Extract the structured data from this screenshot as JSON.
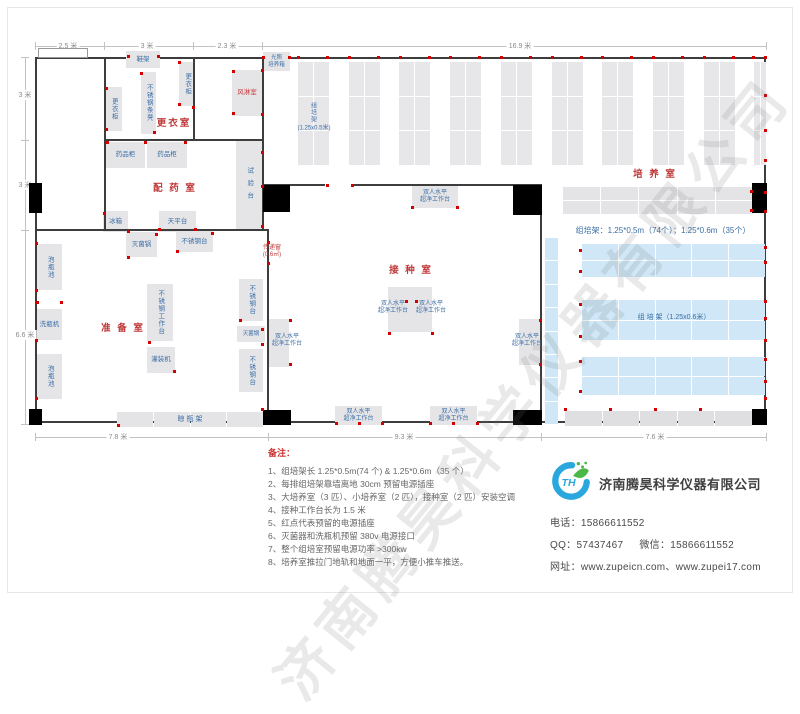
{
  "watermark": "济南腾昊科学仪器有限公司",
  "plan": {
    "rooms": [
      {
        "n": "changing-room",
        "l": "更衣室",
        "x": 174,
        "y": 122
      },
      {
        "n": "medicine-prep-room",
        "l": "配 药 室",
        "x": 175,
        "y": 187
      },
      {
        "n": "prep-room",
        "l": "准 备 室",
        "x": 123,
        "y": 327
      },
      {
        "n": "inoculation-room",
        "l": "接 种 室",
        "x": 411,
        "y": 269
      },
      {
        "n": "culture-room",
        "l": "培 养 室",
        "x": 655,
        "y": 173
      }
    ],
    "dim_top": [
      {
        "label": "2.5 米",
        "cx": 68
      },
      {
        "label": "3 米",
        "cx": 147
      },
      {
        "label": "2.3 米",
        "cx": 227
      },
      {
        "label": "16.9 米",
        "cx": 520
      }
    ],
    "dim_left": [
      {
        "label": "3 米",
        "cy": 95
      },
      {
        "label": "3 米",
        "cy": 185
      },
      {
        "label": "6.6 米",
        "cy": 335
      }
    ],
    "dim_bottom": [
      {
        "label": "7.8 米",
        "cx": 118
      },
      {
        "label": "9.3 米",
        "cx": 404
      },
      {
        "label": "7.6 米",
        "cx": 655
      }
    ],
    "dim_top_ticks": [
      35,
      104,
      193,
      262,
      766
    ],
    "dim_left_ticks": [
      57,
      140,
      230,
      424
    ],
    "dim_bottom_ticks": [
      35,
      268,
      541,
      766
    ],
    "walls": [
      [
        104,
        57,
        2,
        173
      ],
      [
        193,
        57,
        2,
        83
      ],
      [
        262,
        57,
        2,
        173
      ],
      [
        104,
        139,
        160,
        2
      ],
      [
        35,
        229,
        233,
        2
      ],
      [
        267,
        229,
        2,
        196
      ],
      [
        262,
        184,
        280,
        2
      ],
      [
        540,
        184,
        2,
        241
      ]
    ],
    "openings": [
      [
        325,
        181,
        28,
        7
      ]
    ],
    "doors": [
      [
        29,
        183,
        13,
        30
      ],
      [
        29,
        409,
        13,
        16
      ],
      [
        263,
        185,
        27,
        27
      ],
      [
        513,
        185,
        29,
        30
      ],
      [
        263,
        410,
        28,
        15
      ],
      [
        513,
        410,
        29,
        15
      ],
      [
        752,
        183,
        15,
        30
      ],
      [
        752,
        409,
        15,
        16
      ]
    ],
    "window": [
      38,
      48,
      48,
      8
    ],
    "rack_columns": {
      "x0": 298,
      "step": 50.7,
      "count": 10,
      "w": 31,
      "y": 62,
      "h": 103,
      "r": 3,
      "c": 2,
      "clip": 766
    },
    "rack_grids": [
      {
        "x": 563,
        "y": 187,
        "w": 190,
        "h": 27,
        "r": 2,
        "c": 5,
        "col": "#e4e4e7"
      },
      {
        "x": 117,
        "y": 412,
        "w": 146,
        "h": 15,
        "r": 1,
        "c": 4,
        "col": "#e4e4e7"
      },
      {
        "x": 565,
        "y": 411,
        "w": 187,
        "h": 15,
        "r": 1,
        "c": 5,
        "col": "#dfdfe2"
      },
      {
        "x": 545,
        "y": 238,
        "w": 13,
        "h": 186,
        "r": 8,
        "c": 1,
        "col": "#cfe7f7"
      },
      {
        "x": 582,
        "y": 244,
        "w": 183,
        "h": 33,
        "r": 2,
        "c": 5,
        "col": "#cfe7f7"
      },
      {
        "x": 582,
        "y": 300,
        "w": 183,
        "h": 40,
        "r": 2,
        "c": 5,
        "col": "#cfe7f7"
      },
      {
        "x": 582,
        "y": 357,
        "w": 183,
        "h": 38,
        "r": 2,
        "c": 5,
        "col": "#cfe7f7"
      }
    ],
    "equipment": [
      {
        "n": "shoe-rack",
        "l": "鞋架",
        "x": 126,
        "y": 51,
        "w": 34,
        "h": 17,
        "d": "h"
      },
      {
        "n": "locker",
        "l": "更衣柜",
        "x": 179,
        "y": 62,
        "w": 16,
        "h": 44,
        "d": "v"
      },
      {
        "n": "stainless-bench",
        "l": "不锈钢条凳",
        "x": 141,
        "y": 72,
        "w": 15,
        "h": 62,
        "d": "v"
      },
      {
        "n": "locker",
        "l": "更衣柜",
        "x": 105,
        "y": 87,
        "w": 17,
        "h": 44,
        "d": "v"
      },
      {
        "n": "air-shower-room",
        "l": "风淋室",
        "x": 232,
        "y": 70,
        "w": 30,
        "h": 46,
        "d": "h",
        "c": "red"
      },
      {
        "n": "medicine-cabinet",
        "l": "药品柜",
        "x": 106,
        "y": 142,
        "w": 39,
        "h": 26,
        "d": "h"
      },
      {
        "n": "medicine-cabinet",
        "l": "药品柜",
        "x": 147,
        "y": 142,
        "w": 40,
        "h": 26,
        "d": "h"
      },
      {
        "n": "test-bench",
        "l": "试验台",
        "x": 236,
        "y": 141,
        "w": 26,
        "h": 89,
        "d": "v",
        "sp": 1
      },
      {
        "n": "fridge",
        "l": "冰箱",
        "x": 103,
        "y": 211,
        "w": 25,
        "h": 21,
        "d": "h"
      },
      {
        "n": "balance-table",
        "l": "天平台",
        "x": 159,
        "y": 211,
        "w": 37,
        "h": 21,
        "d": "h"
      },
      {
        "n": "soaking-pool",
        "l": "泡瓶池",
        "x": 37,
        "y": 244,
        "w": 25,
        "h": 46,
        "d": "v"
      },
      {
        "n": "bottle-washer",
        "l": "洗瓶机",
        "x": 37,
        "y": 309,
        "w": 25,
        "h": 31,
        "d": "h"
      },
      {
        "n": "soaking-pool",
        "l": "泡瓶池",
        "x": 37,
        "y": 354,
        "w": 25,
        "h": 45,
        "d": "v"
      },
      {
        "n": "sterilizer",
        "l": "灭菌锅",
        "x": 126,
        "y": 232,
        "w": 31,
        "h": 25,
        "d": "h"
      },
      {
        "n": "stainless-table",
        "l": "不锈钢台",
        "x": 176,
        "y": 231,
        "w": 37,
        "h": 21,
        "d": "h"
      },
      {
        "n": "stainless-worktable",
        "l": "不锈钢工作台",
        "x": 147,
        "y": 284,
        "w": 26,
        "h": 57,
        "d": "v"
      },
      {
        "n": "filling-machine",
        "l": "灌装机",
        "x": 147,
        "y": 347,
        "w": 28,
        "h": 26,
        "d": "h"
      },
      {
        "n": "stainless-table",
        "l": "不锈钢台",
        "x": 239,
        "y": 279,
        "w": 24,
        "h": 42,
        "d": "v"
      },
      {
        "n": "sterilizer",
        "l": "灭菌锅",
        "x": 237,
        "y": 326,
        "w": 28,
        "h": 16,
        "d": "h",
        "fs": 5.5
      },
      {
        "n": "stainless-table",
        "l": "不锈钢台",
        "x": 239,
        "y": 349,
        "w": 24,
        "h": 43,
        "d": "v"
      },
      {
        "n": "light-incubator",
        "l": "光照|培养箱",
        "x": 263,
        "y": 52,
        "w": 27,
        "h": 19,
        "d": "h",
        "fs": 5.5
      },
      {
        "n": "clean-bench",
        "l": "双人水平|超净工作台",
        "x": 412,
        "y": 186,
        "w": 46,
        "h": 22,
        "d": "h",
        "fs": 6
      },
      {
        "n": "clean-bench",
        "l": "",
        "x": 268,
        "y": 319,
        "w": 21,
        "h": 48,
        "d": "h"
      },
      {
        "n": "clean-bench",
        "l": "",
        "x": 388,
        "y": 287,
        "w": 22,
        "h": 45,
        "d": "h"
      },
      {
        "n": "clean-bench",
        "l": "",
        "x": 410,
        "y": 287,
        "w": 22,
        "h": 45,
        "d": "h"
      },
      {
        "n": "clean-bench",
        "l": "",
        "x": 519,
        "y": 319,
        "w": 22,
        "h": 46,
        "d": "h"
      },
      {
        "n": "clean-bench",
        "l": "双人水平|超净工作台",
        "x": 335,
        "y": 406,
        "w": 47,
        "h": 19,
        "d": "h",
        "fs": 6
      },
      {
        "n": "clean-bench",
        "l": "双人水平|超净工作台",
        "x": 430,
        "y": 406,
        "w": 47,
        "h": 19,
        "d": "h",
        "fs": 6
      }
    ],
    "labels": [
      {
        "t": "双人水平|超净工作台",
        "x": 393,
        "y": 308,
        "fs": 6
      },
      {
        "t": "双人水平|超净工作台",
        "x": 431,
        "y": 308,
        "fs": 6
      },
      {
        "t": "双人水平|超净工作台",
        "x": 287,
        "y": 341,
        "fs": 6
      },
      {
        "t": "双人水平|超净工作台",
        "x": 527,
        "y": 341,
        "fs": 6
      },
      {
        "t": "传递窗|(0.6㎡)",
        "x": 272,
        "y": 252,
        "fs": 6,
        "c": "red"
      },
      {
        "t": "组|培|架|(1.25x0.5米)",
        "x": 314,
        "y": 118,
        "fs": 6
      },
      {
        "t": "组培架：1.25*0.5m（74个）；1.25*0.6m（35个）",
        "x": 663,
        "y": 231,
        "fs": 8
      },
      {
        "t": "组 培 架（1.25x0.6米）",
        "x": 674,
        "y": 318,
        "fs": 7
      },
      {
        "t": "晾  瓶  架",
        "x": 190,
        "y": 420,
        "fs": 7
      }
    ],
    "dots": [
      [
        298,
        57
      ],
      [
        327,
        57
      ],
      [
        349,
        57
      ],
      [
        378,
        57
      ],
      [
        400,
        57
      ],
      [
        429,
        57
      ],
      [
        450,
        57
      ],
      [
        479,
        57
      ],
      [
        501,
        57
      ],
      [
        530,
        57
      ],
      [
        552,
        57
      ],
      [
        581,
        57
      ],
      [
        602,
        57
      ],
      [
        631,
        57
      ],
      [
        653,
        57
      ],
      [
        682,
        57
      ],
      [
        704,
        57
      ],
      [
        733,
        57
      ],
      [
        753,
        57
      ],
      [
        765,
        57
      ],
      [
        765,
        95
      ],
      [
        765,
        130
      ],
      [
        765,
        160
      ],
      [
        765,
        192
      ],
      [
        765,
        211
      ],
      [
        765,
        247
      ],
      [
        765,
        262
      ],
      [
        765,
        301
      ],
      [
        765,
        318
      ],
      [
        765,
        340
      ],
      [
        765,
        359
      ],
      [
        765,
        381
      ],
      [
        765,
        398
      ],
      [
        327,
        185
      ],
      [
        352,
        185
      ],
      [
        412,
        207
      ],
      [
        457,
        207
      ],
      [
        406,
        301
      ],
      [
        416,
        301
      ],
      [
        389,
        333
      ],
      [
        432,
        333
      ],
      [
        290,
        320
      ],
      [
        290,
        364
      ],
      [
        540,
        320
      ],
      [
        540,
        364
      ],
      [
        336,
        423
      ],
      [
        359,
        423
      ],
      [
        382,
        423
      ],
      [
        430,
        423
      ],
      [
        453,
        423
      ],
      [
        477,
        423
      ],
      [
        268,
        242
      ],
      [
        268,
        263
      ],
      [
        37,
        302
      ],
      [
        61,
        302
      ],
      [
        128,
        257
      ],
      [
        156,
        234
      ],
      [
        177,
        251
      ],
      [
        212,
        233
      ],
      [
        240,
        320
      ],
      [
        262,
        329
      ],
      [
        262,
        344
      ],
      [
        174,
        371
      ],
      [
        149,
        342
      ],
      [
        118,
        425
      ],
      [
        262,
        409
      ],
      [
        262,
        152
      ],
      [
        262,
        186
      ],
      [
        262,
        226
      ],
      [
        104,
        213
      ],
      [
        128,
        231
      ],
      [
        159,
        229
      ],
      [
        195,
        229
      ],
      [
        107,
        142
      ],
      [
        145,
        142
      ],
      [
        185,
        142
      ],
      [
        106,
        88
      ],
      [
        106,
        129
      ],
      [
        128,
        56
      ],
      [
        158,
        56
      ],
      [
        141,
        73
      ],
      [
        154,
        132
      ],
      [
        179,
        62
      ],
      [
        179,
        104
      ],
      [
        193,
        107
      ],
      [
        233,
        71
      ],
      [
        233,
        113
      ],
      [
        262,
        70
      ],
      [
        262,
        114
      ],
      [
        263,
        57
      ],
      [
        289,
        57
      ],
      [
        36,
        243
      ],
      [
        36,
        290
      ],
      [
        36,
        340
      ],
      [
        36,
        398
      ],
      [
        565,
        409
      ],
      [
        610,
        409
      ],
      [
        655,
        409
      ],
      [
        700,
        409
      ],
      [
        580,
        250
      ],
      [
        580,
        271
      ],
      [
        580,
        304
      ],
      [
        580,
        336
      ],
      [
        580,
        361
      ],
      [
        580,
        391
      ],
      [
        751,
        191
      ],
      [
        751,
        210
      ]
    ]
  },
  "notes": {
    "title": "备注：",
    "items": [
      "1、组培架长 1.25*0.5m(74 个) & 1.25*0.6m（35 个）",
      "2、每排组培架靠墙离地 30cm 预留电源插座",
      "3、大培养室（3 匹）、小培养室（2 匹），接种室（2 匹）安装空调",
      "4、接种工作台长为 1.5 米",
      "5、红点代表预留的电源插座",
      "6、灭菌器和洗瓶机预留 380v 电源接口",
      "7、整个组培室预留电源功率 >300kw",
      "8、培养室推拉门地轨和地面一平，方便小推车推送。"
    ]
  },
  "contact": {
    "company": "济南腾昊科学仪器有限公司",
    "phone_label": "电话：",
    "phone": "15866611552",
    "qq_label": "QQ：",
    "qq": "57437467",
    "wechat_label": "微信：",
    "wechat": "15866611552",
    "web_label": "网址：",
    "web": "www.zupeicn.com、www.zupei17.com"
  }
}
